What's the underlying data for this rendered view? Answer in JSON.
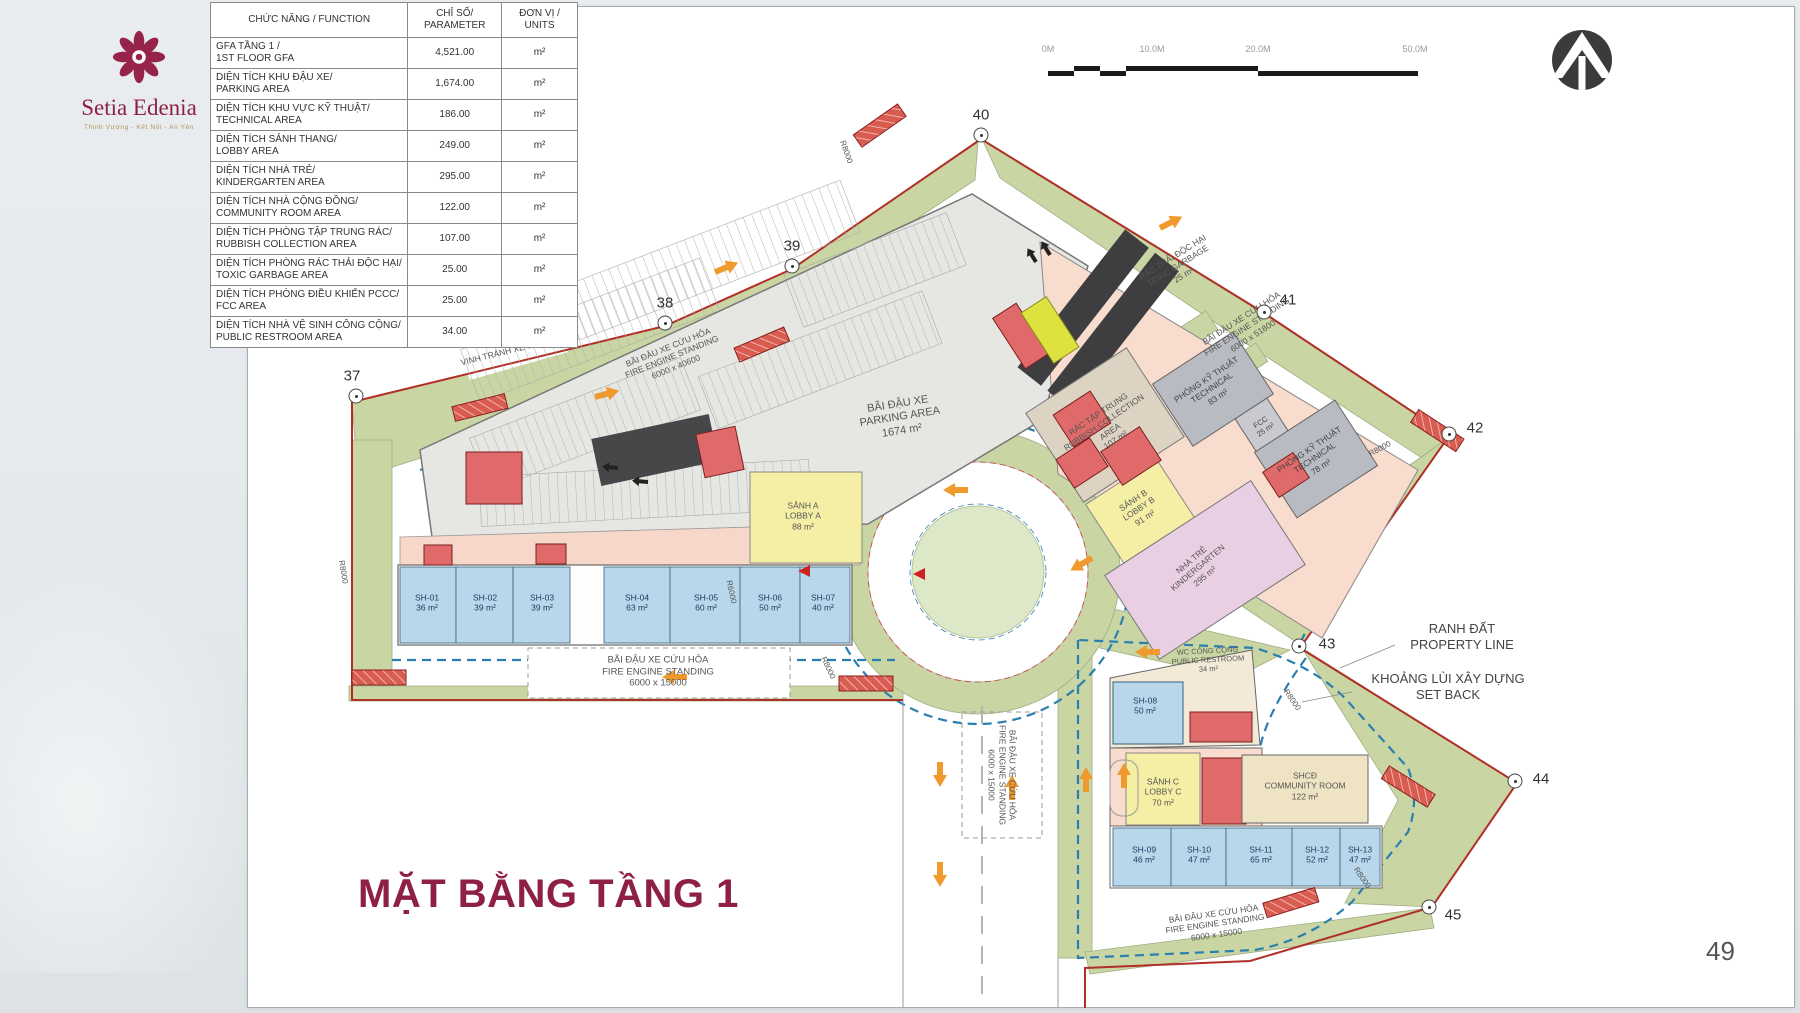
{
  "logo": {
    "name": "Setia Edenia",
    "tagline": "Thịnh Vượng - Kết Nối - An Yên"
  },
  "title": "MẶT BẰNG TẦNG 1",
  "page_number": "49",
  "table": {
    "headers": [
      "CHỨC NĂNG / FUNCTION",
      "CHỈ SỐ/\nPARAMETER",
      "ĐƠN VỊ /\nUNITS"
    ],
    "rows": [
      {
        "function": "GFA TẦNG 1 /\n1ST FLOOR GFA",
        "parameter": "4,521.00",
        "unit": "m²"
      },
      {
        "function": "DIỆN TÍCH KHU ĐẬU XE/\nPARKING AREA",
        "parameter": "1,674.00",
        "unit": "m²"
      },
      {
        "function": "DIỆN TÍCH KHU VỰC KỸ THUẬT/\nTECHNICAL AREA",
        "parameter": "186.00",
        "unit": "m²"
      },
      {
        "function": "DIỆN TÍCH SẢNH THANG/\nLOBBY AREA",
        "parameter": "249.00",
        "unit": "m²"
      },
      {
        "function": "DIỆN TÍCH NHÀ TRẺ/\nKINDERGARTEN AREA",
        "parameter": "295.00",
        "unit": "m²"
      },
      {
        "function": "DIỆN TÍCH NHÀ CỘNG ĐỒNG/\nCOMMUNITY ROOM AREA",
        "parameter": "122.00",
        "unit": "m²"
      },
      {
        "function": "DIỆN TÍCH PHÒNG TẬP TRUNG RÁC/\nRUBBISH COLLECTION AREA",
        "parameter": "107.00",
        "unit": "m²"
      },
      {
        "function": "DIỆN TÍCH PHÒNG RÁC THẢI ĐỘC HẠI/\nTOXIC GARBAGE AREA",
        "parameter": "25.00",
        "unit": "m²"
      },
      {
        "function": "DIỆN TÍCH PHÒNG ĐIỀU KHIỂN PCCC/\nFCC AREA",
        "parameter": "25.00",
        "unit": "m²"
      },
      {
        "function": "DIỆN TÍCH NHÀ VỆ SINH CÔNG CỘNG/\nPUBLIC RESTROOM AREA",
        "parameter": "34.00",
        "unit": "m²"
      }
    ]
  },
  "scale_bar": {
    "labels": [
      {
        "t": "0M",
        "x": 8
      },
      {
        "t": "10.0M",
        "x": 112
      },
      {
        "t": "20.0M",
        "x": 218
      },
      {
        "t": "50.0M",
        "x": 375
      }
    ]
  },
  "plan": {
    "labels": [
      {
        "t": "BÃI ĐẬU XE\nPARKING AREA\n1674 m²",
        "x": 900,
        "y": 418,
        "r": -9,
        "s": 11
      },
      {
        "t": "RÁC TẬP TRUNG\nRUBBISH COLLECTION\nAREA\n107 m²",
        "x": 1107,
        "y": 427,
        "r": -34,
        "s": 8.5
      },
      {
        "t": "PHÒNG KỸ THUẬT\nTECHNICAL\n83 m²",
        "x": 1212,
        "y": 388,
        "r": -34,
        "s": 8.5,
        "c": "#444"
      },
      {
        "t": "FCC\n25 m²",
        "x": 1263,
        "y": 426,
        "r": -34,
        "s": 7.5,
        "c": "#444"
      },
      {
        "t": "PHÒNG KỸ THUẬT\nTECHNICAL\n78 m²",
        "x": 1315,
        "y": 458,
        "r": -34,
        "s": 8.5,
        "c": "#444"
      },
      {
        "t": "SẢNH B\nLOBBY B\n91 m²",
        "x": 1139,
        "y": 509,
        "r": -34,
        "s": 8.5
      },
      {
        "t": "NHÀ TRẺ\nKINDERGARTEN\n295 m²",
        "x": 1198,
        "y": 568,
        "r": -40,
        "s": 8.5
      },
      {
        "t": "SẢNH A\nLOBBY A\n88 m²",
        "x": 803,
        "y": 516,
        "r": 0,
        "s": 8.5
      },
      {
        "t": "RÁC THẢI ĐỘC HẠI\nTOXIC GARBAGE\n25 m²",
        "x": 1178,
        "y": 266,
        "r": -32,
        "s": 8.5
      },
      {
        "t": "BÃI ĐẬU XE CỨU HỎA\nFIRE ENGINE STANDING\n6000 x 51800",
        "x": 1247,
        "y": 327,
        "r": -33,
        "s": 8.5
      },
      {
        "t": "BÃI ĐẬU XE CỨU HỎA\nFIRE ENGINE STANDING\n6000 x 40600",
        "x": 672,
        "y": 357,
        "r": -22,
        "s": 8.5
      },
      {
        "t": "VỊNH TRÁNH XE 7MX6M",
        "x": 508,
        "y": 351,
        "r": -14,
        "s": 8.5
      },
      {
        "t": "BÃI ĐẬU XE CỨU HỎA\nFIRE ENGINE STANDING\n6000 x 15000",
        "x": 658,
        "y": 672,
        "r": 0,
        "s": 9.5
      },
      {
        "t": "BÃI ĐẬU XE CỨU HỎA\nFIRE ENGINE STANDING\n6000 x 15000",
        "x": 1002,
        "y": 775,
        "r": 90,
        "s": 8.5
      },
      {
        "t": "BÃI ĐẬU XE CỨU HỎA\nFIRE ENGINE STANDING\n6000 x 15000",
        "x": 1215,
        "y": 924,
        "r": -8,
        "s": 8.5
      },
      {
        "t": "WC CÔNG CỘNG\nPUBLIC RESTROOM\n34 m²",
        "x": 1208,
        "y": 660,
        "r": -3,
        "s": 7.5
      },
      {
        "t": "SH-08\n50 m²",
        "x": 1145,
        "y": 706,
        "r": 0,
        "s": 8.5,
        "c": "#1c3f63"
      },
      {
        "t": "SẢNH C\nLOBBY C\n70 m²",
        "x": 1163,
        "y": 792,
        "r": 0,
        "s": 8.5
      },
      {
        "t": "SHCĐ\nCOMMUNITY ROOM\n122 m²",
        "x": 1305,
        "y": 786,
        "r": 0,
        "s": 8.5
      },
      {
        "t": "SH-01\n36 m²",
        "x": 427,
        "y": 603,
        "r": 0,
        "s": 8.5,
        "c": "#1c3f63"
      },
      {
        "t": "SH-02\n39 m²",
        "x": 485,
        "y": 603,
        "r": 0,
        "s": 8.5,
        "c": "#1c3f63"
      },
      {
        "t": "SH-03\n39 m²",
        "x": 542,
        "y": 603,
        "r": 0,
        "s": 8.5,
        "c": "#1c3f63"
      },
      {
        "t": "SH-04\n63 m²",
        "x": 637,
        "y": 603,
        "r": 0,
        "s": 8.5,
        "c": "#1c3f63"
      },
      {
        "t": "SH-05\n60 m²",
        "x": 706,
        "y": 603,
        "r": 0,
        "s": 8.5,
        "c": "#1c3f63"
      },
      {
        "t": "SH-06\n50 m²",
        "x": 770,
        "y": 603,
        "r": 0,
        "s": 8.5,
        "c": "#1c3f63"
      },
      {
        "t": "SH-07\n40 m²",
        "x": 823,
        "y": 603,
        "r": 0,
        "s": 8.5,
        "c": "#1c3f63"
      },
      {
        "t": "SH-09\n46 m²",
        "x": 1144,
        "y": 855,
        "r": 0,
        "s": 8.5,
        "c": "#1c3f63"
      },
      {
        "t": "SH-10\n47 m²",
        "x": 1199,
        "y": 855,
        "r": 0,
        "s": 8.5,
        "c": "#1c3f63"
      },
      {
        "t": "SH-11\n65 m²",
        "x": 1261,
        "y": 855,
        "r": 0,
        "s": 8.5,
        "c": "#1c3f63"
      },
      {
        "t": "SH-12\n52 m²",
        "x": 1317,
        "y": 855,
        "r": 0,
        "s": 8.5,
        "c": "#1c3f63"
      },
      {
        "t": "SH-13\n47 m²",
        "x": 1360,
        "y": 855,
        "r": 0,
        "s": 8.5,
        "c": "#1c3f63"
      },
      {
        "t": "RANH ĐẤT\nPROPERTY LINE",
        "x": 1462,
        "y": 637,
        "r": 0,
        "s": 13,
        "c": "#444"
      },
      {
        "t": "KHOẢNG LÙI XÂY DỰNG\nSET BACK",
        "x": 1448,
        "y": 687,
        "r": 0,
        "s": 13,
        "c": "#444"
      },
      {
        "t": "R8000",
        "x": 828,
        "y": 668,
        "r": 65,
        "s": 8
      },
      {
        "t": "R8000",
        "x": 1292,
        "y": 700,
        "r": 55,
        "s": 8
      },
      {
        "t": "R8000",
        "x": 1362,
        "y": 878,
        "r": 55,
        "s": 8
      },
      {
        "t": "R6000",
        "x": 731,
        "y": 592,
        "r": 78,
        "s": 8
      },
      {
        "t": "R8000",
        "x": 343,
        "y": 572,
        "r": 80,
        "s": 8
      },
      {
        "t": "R8000",
        "x": 1380,
        "y": 449,
        "r": -28,
        "s": 8
      },
      {
        "t": "R8000",
        "x": 846,
        "y": 152,
        "r": 70,
        "s": 8
      }
    ],
    "markers": [
      {
        "n": "37",
        "x": 356,
        "y": 396,
        "lx": -4,
        "ly": -20
      },
      {
        "n": "38",
        "x": 665,
        "y": 323,
        "lx": 0,
        "ly": -20
      },
      {
        "n": "39",
        "x": 792,
        "y": 266,
        "lx": 0,
        "ly": -20
      },
      {
        "n": "40",
        "x": 981,
        "y": 135,
        "lx": 0,
        "ly": -20
      },
      {
        "n": "41",
        "x": 1264,
        "y": 312,
        "lx": 24,
        "ly": -12
      },
      {
        "n": "42",
        "x": 1449,
        "y": 434,
        "lx": 26,
        "ly": -6
      },
      {
        "n": "43",
        "x": 1299,
        "y": 646,
        "lx": 28,
        "ly": -2
      },
      {
        "n": "44",
        "x": 1515,
        "y": 781,
        "lx": 26,
        "ly": -2
      },
      {
        "n": "45",
        "x": 1429,
        "y": 907,
        "lx": 24,
        "ly": 8
      }
    ]
  }
}
